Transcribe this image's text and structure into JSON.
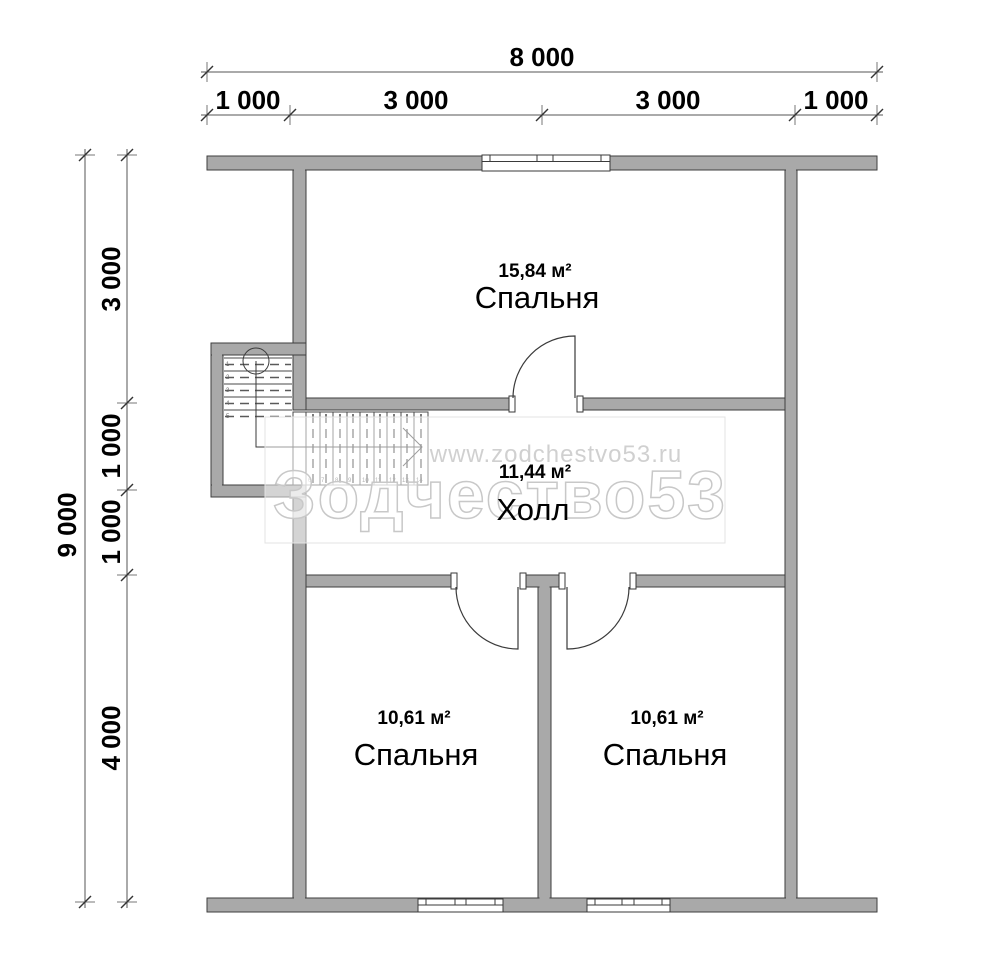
{
  "plan": {
    "rooms": {
      "bedroom_top": {
        "area": "15,84 м²",
        "name": "Спальня"
      },
      "hall": {
        "area": "11,44 м²",
        "name": "Холл"
      },
      "bedroom_left": {
        "area": "10,61 м²",
        "name": "Спальня"
      },
      "bedroom_right": {
        "area": "10,61 м²",
        "name": "Спальня"
      }
    },
    "dimensions": {
      "top_total": "8 000",
      "top_segments": [
        "1 000",
        "3 000",
        "3 000",
        "1 000"
      ],
      "left_total": "9 000",
      "left_segments": [
        "3 000",
        "1 000",
        "1 000",
        "4 000"
      ]
    },
    "stairs": {
      "upper_steps": [
        "1",
        "2",
        "3",
        "4",
        "5"
      ],
      "lower_steps": [
        "6",
        "7",
        "8",
        "9",
        "10",
        "11",
        "12",
        "13",
        "14"
      ]
    },
    "watermark": {
      "site": "www.zodchestvo53.ru",
      "brand": "Зодчество53"
    },
    "colors": {
      "wall_fill": "#a9a9a9",
      "wall_stroke": "#3e3e3e",
      "line": "#3a3a3a",
      "dimension_text": "#000000",
      "watermark": "#cccccc",
      "background": "#ffffff"
    }
  }
}
